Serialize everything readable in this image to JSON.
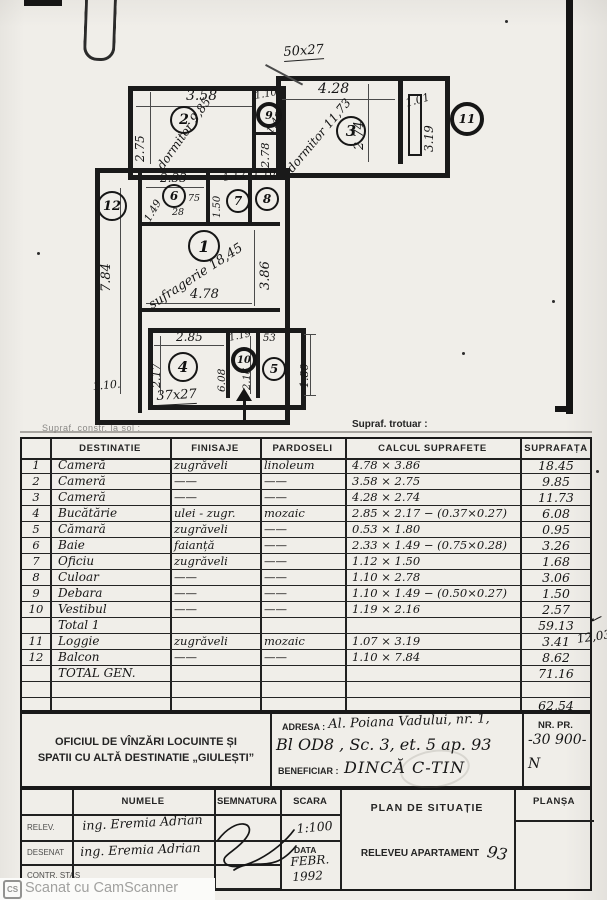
{
  "scan": {
    "watermark_icon": "CS",
    "watermark_text": "Scanat cu CamScanner"
  },
  "plan": {
    "opening_top": "50x27",
    "opening_bottom": "37x27",
    "camera2": {
      "num": "2",
      "note": "dormitor 9,85",
      "dim_top": "3.58",
      "dim_left": "2.75"
    },
    "camera3": {
      "num": "3",
      "note": "dormitor 11,73",
      "dim_top": "4.28",
      "dim_side": "2.74"
    },
    "loggia": {
      "num": "11",
      "dim_top": "1.01",
      "dim_side": "3.19"
    },
    "debara": {
      "num": "9",
      "dim_top": "1.10",
      "dim_diag": "1.49"
    },
    "culoar": {
      "num": "8",
      "dim_top": "1.10",
      "dim_side": "2.78"
    },
    "baie": {
      "num": "6",
      "dim_top": "2.33",
      "dim_diag": "1.49",
      "sub_w": "75",
      "sub_h": "28"
    },
    "oficiu": {
      "num": "7",
      "dim_top": "1.12",
      "dim_side": "1.50"
    },
    "balcon": {
      "num": "12",
      "dim_side": "7.84",
      "dim_bottom": "1.10."
    },
    "camera1": {
      "num": "1",
      "note": "sufragerie 18,45",
      "dim_bottom": "4.78",
      "dim_side": "3.86"
    },
    "bucatarie": {
      "num": "4",
      "dim_top": "2.85",
      "dim_left": "2.17",
      "note": "6.08"
    },
    "vestibul": {
      "num": "10",
      "dim_top": "1.19",
      "dim_side": "2.16"
    },
    "camara": {
      "num": "5",
      "dim_top": "53",
      "dim_side": "1.80"
    }
  },
  "table": {
    "caption_left": "Supraf. constr. la sol :",
    "caption_right": "Supraf. trotuar :",
    "headers": {
      "nr": "",
      "destinatie": "DESTINATIE",
      "finisaje": "FINISAJE",
      "pardoseli": "PARDOSELI",
      "calcul": "CALCUL SUPRAFETE",
      "suprafata": "SUPRAFAȚA"
    },
    "rows": [
      {
        "nr": "1",
        "dest": "Cameră",
        "fin": "zugrăveli",
        "pard": "linoleum",
        "calc": "4.78 × 3.86",
        "sup": "18.45"
      },
      {
        "nr": "2",
        "dest": "Cameră",
        "fin": "——",
        "pard": "——",
        "calc": "3.58 × 2.75",
        "sup": "9.85"
      },
      {
        "nr": "3",
        "dest": "Cameră",
        "fin": "——",
        "pard": "——",
        "calc": "4.28 × 2.74",
        "sup": "11.73"
      },
      {
        "nr": "4",
        "dest": "Bucătărie",
        "fin": "ulei - zugr.",
        "pard": "mozaic",
        "calc": "2.85 × 2.17 − (0.37×0.27)",
        "sup": "6.08"
      },
      {
        "nr": "5",
        "dest": "Cămară",
        "fin": "zugrăveli",
        "pard": "——",
        "calc": "0.53 × 1.80",
        "sup": "0.95"
      },
      {
        "nr": "6",
        "dest": "Baie",
        "fin": "faianță",
        "pard": "——",
        "calc": "2.33 × 1.49 − (0.75×0.28)",
        "sup": "3.26"
      },
      {
        "nr": "7",
        "dest": "Oficiu",
        "fin": "zugrăveli",
        "pard": "——",
        "calc": "1.12 × 1.50",
        "sup": "1.68"
      },
      {
        "nr": "8",
        "dest": "Culoar",
        "fin": "——",
        "pard": "——",
        "calc": "1.10 × 2.78",
        "sup": "3.06"
      },
      {
        "nr": "9",
        "dest": "Debara",
        "fin": "——",
        "pard": "——",
        "calc": "1.10 × 1.49 − (0.50×0.27)",
        "sup": "1.50"
      },
      {
        "nr": "10",
        "dest": "Vestibul",
        "fin": "——",
        "pard": "——",
        "calc": "1.19 × 2.16",
        "sup": "2.57"
      },
      {
        "nr": "",
        "dest": "Total 1",
        "fin": "",
        "pard": "",
        "calc": "",
        "sup": "59.13"
      },
      {
        "nr": "11",
        "dest": "Loggie",
        "fin": "zugrăveli",
        "pard": "mozaic",
        "calc": "1.07 × 3.19",
        "sup": "3.41"
      },
      {
        "nr": "12",
        "dest": "Balcon",
        "fin": "——",
        "pard": "——",
        "calc": "1.10 × 7.84",
        "sup": "8.62"
      },
      {
        "nr": "",
        "dest": "TOTAL GEN.",
        "fin": "",
        "pard": "",
        "calc": "",
        "sup": "71.16"
      },
      {
        "nr": "",
        "dest": "",
        "fin": "",
        "pard": "",
        "calc": "",
        "sup": ""
      },
      {
        "nr": "",
        "dest": "",
        "fin": "",
        "pard": "",
        "calc": "",
        "sup": "62,54"
      }
    ],
    "margin_check": "✓",
    "margin_note": "12,03"
  },
  "office": {
    "name_line1": "OFICIUL DE VÎNZĂRI LOCUINTE ȘI",
    "name_line2": "SPATII CU ALTĂ DESTINATIE „GIULEȘTI”",
    "adresa_label": "ADRESA :",
    "adresa_value_1": "Al. Poiana Vadului, nr. 1,",
    "adresa_value_2": "Bl OD8 , Sc. 3, et. 5 ap. 93",
    "beneficiar_label": "BENEFICIAR :",
    "beneficiar_value": "DINCĂ  C-TIN",
    "nr_pr_label": "NR.  PR.",
    "nr_pr_value": "-30 900-",
    "nr_pr_note": "N"
  },
  "titleblock": {
    "col_numele": "NUMELE",
    "col_semnatura": "SEMNATURA",
    "col_scara": "SCARA",
    "col_plansa": "PLANȘA",
    "row1_label": "RELEV.",
    "row1_name": "ing. Eremia Adrian",
    "row2_label": "DESENAT",
    "row2_name": "ing. Eremia Adrian",
    "row3_label": "CONTR. STAS",
    "scara_value": "1:100",
    "data_label": "DATA",
    "data_value_1": "FEBR.",
    "data_value_2": "1992",
    "title_1": "PLAN  DE  SITUAȚIE",
    "title_2": "RELEVEU  APARTAMENT",
    "apartment_num": "93"
  }
}
